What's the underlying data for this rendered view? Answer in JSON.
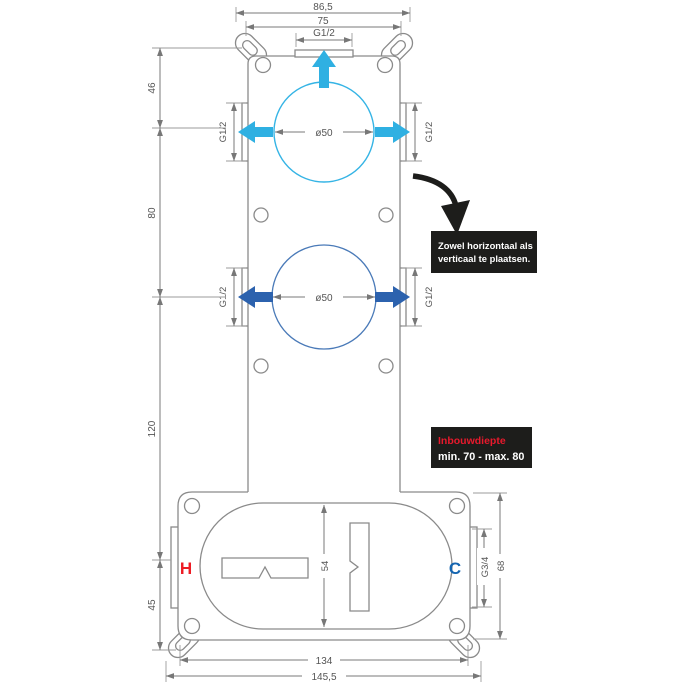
{
  "notes": {
    "placement_line1": "Zowel horizontaal als",
    "placement_line2": "verticaal te plaatsen.",
    "depth_title": "Inbouwdiepte",
    "depth_value": "min. 70 - max. 80"
  },
  "dims": {
    "top_outer": "86,5",
    "top_inner": "75",
    "top_port": "G1/2",
    "side_port_tl": "G1/2",
    "side_port_tr": "G1/2",
    "side_port_bl": "G1/2",
    "side_port_br": "G1/2",
    "circle_top": "ø50",
    "circle_bottom": "ø50",
    "left_46": "46",
    "left_80": "80",
    "left_120": "120",
    "left_45": "45",
    "inner_54": "54",
    "port_g34": "G3/4",
    "right_68": "68",
    "bottom_134": "134",
    "bottom_1455": "145,5"
  },
  "labels": {
    "hot": "H",
    "cold": "C"
  },
  "colors": {
    "cyan": "#35b4e5",
    "blue": "#2c62ae",
    "hot_red": "#ed1c24",
    "cold_blue": "#1565b0",
    "note_black": "#1d1d1b",
    "note_red": "#e8192c",
    "line_gray": "#8a8a8a"
  }
}
